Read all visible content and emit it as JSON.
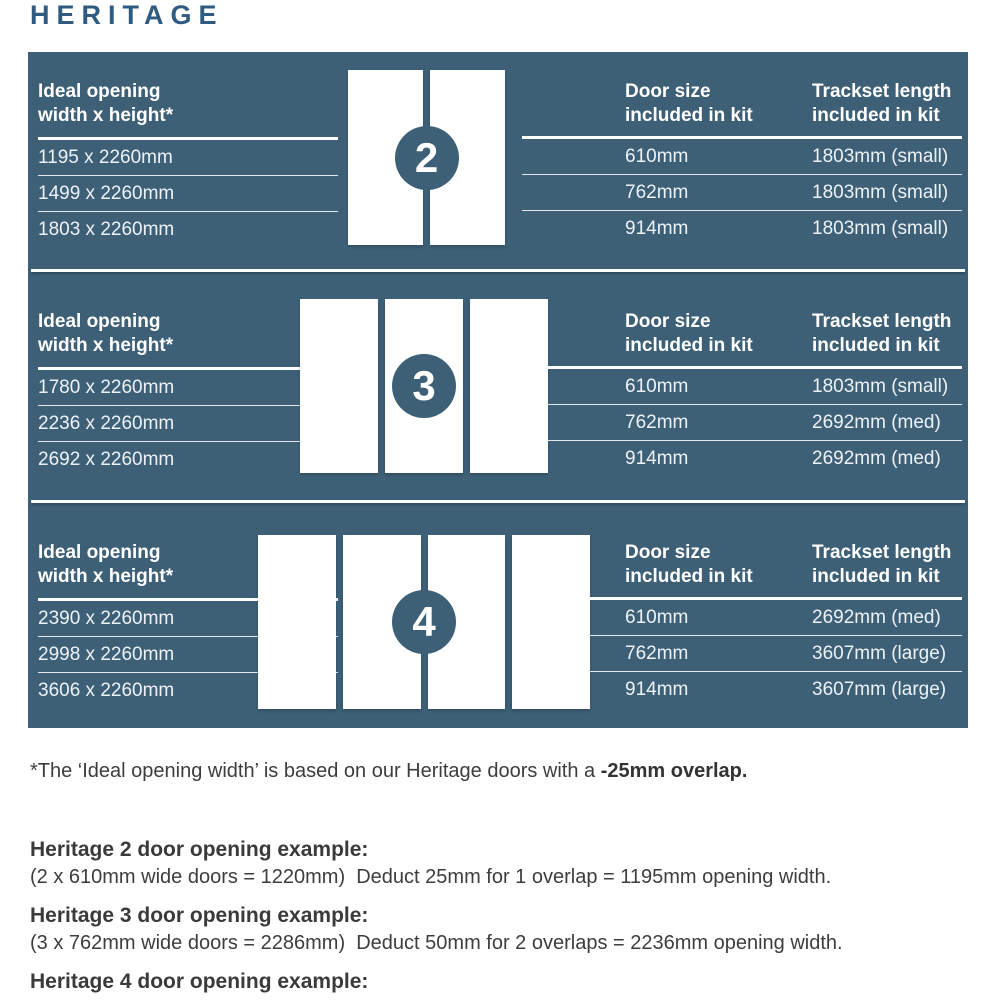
{
  "title": "HERITAGE",
  "colors": {
    "panel_bg": "#3d6077",
    "title_blue": "#2f5b80"
  },
  "headers": {
    "opening_line1": "Ideal opening",
    "opening_line2": "width x height*",
    "door_size_line1": "Door size",
    "door_size_line2": "included in kit",
    "trackset_line1": "Trackset length",
    "trackset_line2": "included in kit"
  },
  "sections": [
    {
      "number": "2",
      "openings": [
        "1195 x 2260mm",
        "1499 x 2260mm",
        "1803 x 2260mm"
      ],
      "door_sizes": [
        "610mm",
        "762mm",
        "914mm"
      ],
      "tracksets": [
        "1803mm (small)",
        "1803mm (small)",
        "1803mm (small)"
      ]
    },
    {
      "number": "3",
      "openings": [
        "1780 x 2260mm",
        "2236 x 2260mm",
        "2692 x 2260mm"
      ],
      "door_sizes": [
        "610mm",
        "762mm",
        "914mm"
      ],
      "tracksets": [
        "1803mm (small)",
        "2692mm (med)",
        "2692mm (med)"
      ]
    },
    {
      "number": "4",
      "openings": [
        "2390 x 2260mm",
        "2998 x 2260mm",
        "3606 x 2260mm"
      ],
      "door_sizes": [
        "610mm",
        "762mm",
        "914mm"
      ],
      "tracksets": [
        "2692mm (med)",
        "3607mm (large)",
        "3607mm (large)"
      ]
    }
  ],
  "footnote": {
    "text": "*The ‘Ideal opening width’ is based on our Heritage doors with a ",
    "bold": "-25mm overlap."
  },
  "examples": [
    {
      "title": "Heritage 2 door opening example:",
      "body": "(2 x 610mm wide doors = 1220mm)  Deduct 25mm for 1 overlap = 1195mm opening width."
    },
    {
      "title": "Heritage 3 door opening example:",
      "body": "(3 x 762mm wide doors = 2286mm)  Deduct 50mm for 2 overlaps = 2236mm opening width."
    },
    {
      "title": "Heritage 4 door opening example:",
      "body": "(4 x 762mm wide doors = 3048mm)  Deduct 50mm for 2 overlaps = 2998mm opening width."
    }
  ]
}
